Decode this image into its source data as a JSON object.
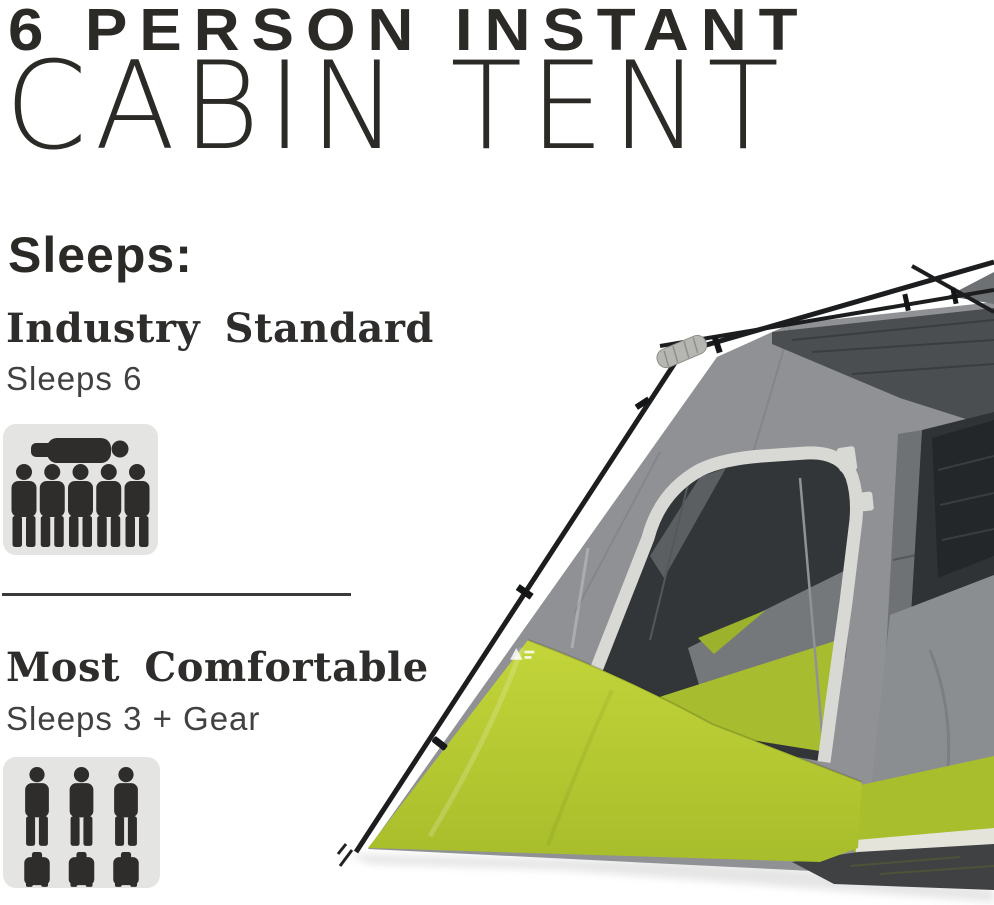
{
  "title": {
    "line1": "6 PERSON INSTANT",
    "line2": "CABIN TENT"
  },
  "capacity": {
    "label": "Sleeps:",
    "sections": [
      {
        "heading": "Industry Standard",
        "detail": "Sleeps 6",
        "icon": "six-person-capacity-icon",
        "standing_figures": 5,
        "sleeping_figures": 1,
        "gear_bags": 0
      },
      {
        "heading": "Most Comfortable",
        "detail": "Sleeps 3 + Gear",
        "icon": "three-person-gear-capacity-icon",
        "standing_figures": 3,
        "sleeping_figures": 0,
        "gear_bags": 3
      }
    ]
  },
  "colors": {
    "text-dark": "#2b2a27",
    "tent-green": "#b7cc31",
    "tent-green-dark": "#a9be2c",
    "tent-gray": "#8f9194",
    "tent-gray-dark": "#4b4e50",
    "tent-interior": "#333638",
    "tent-trim": "#d8d9d4",
    "icon-bg": "#e4e5e3",
    "icon-fg": "#2e2d2b",
    "pole-black": "#1c1d1e"
  }
}
